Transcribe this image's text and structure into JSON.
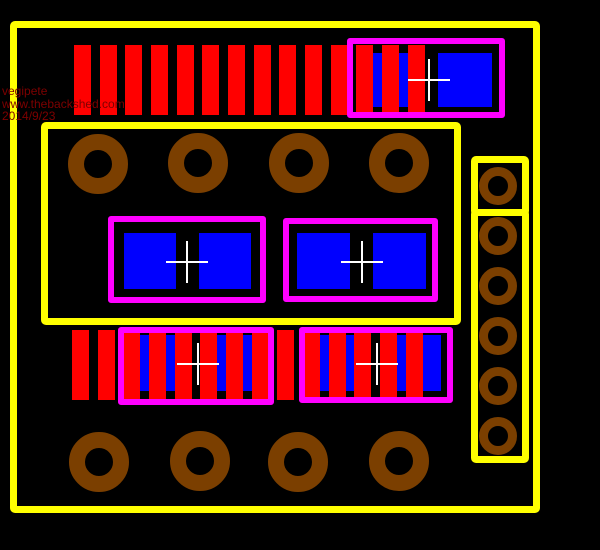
{
  "scene": {
    "kind": "pcb-layout-render",
    "canvas_w": 600,
    "canvas_h": 550
  },
  "watermark": {
    "lines": [
      "vegipete",
      "www.thebackshed.com",
      "2014/9/23"
    ],
    "color": "#7E0000"
  },
  "palette": {
    "background": "#000000",
    "outline_yellow": "#FFFF00",
    "silkscreen_magenta": "#FF00FF",
    "pad_blue": "#0000FF",
    "copper_red": "#FF0000",
    "hole_brown": "#7B3F00",
    "crosshair_white": "#FFFFFF"
  },
  "board": {
    "yellow_outlines": [
      {
        "name": "board-outline",
        "x": 10,
        "y": 21,
        "w": 530,
        "h": 492,
        "stroke": 7
      },
      {
        "name": "inner-block-outline",
        "x": 41,
        "y": 122,
        "w": 420,
        "h": 203,
        "stroke": 7
      },
      {
        "name": "right-header-outline-top",
        "x": 471,
        "y": 156,
        "w": 58,
        "h": 60,
        "stroke": 7
      },
      {
        "name": "right-header-outline-bottom",
        "x": 471,
        "y": 209,
        "w": 58,
        "h": 254,
        "stroke": 7
      }
    ],
    "component_outlines": [
      {
        "name": "component-outline-top-right",
        "x": 347,
        "y": 38,
        "w": 158,
        "h": 80,
        "stroke": 6
      },
      {
        "name": "component-outline-mid-left",
        "x": 108,
        "y": 216,
        "w": 158,
        "h": 87,
        "stroke": 6
      },
      {
        "name": "component-outline-mid-right",
        "x": 283,
        "y": 218,
        "w": 155,
        "h": 84,
        "stroke": 6
      },
      {
        "name": "component-outline-bottom-left",
        "x": 118,
        "y": 327,
        "w": 156,
        "h": 78,
        "stroke": 6
      },
      {
        "name": "component-outline-bottom-right",
        "x": 299,
        "y": 327,
        "w": 154,
        "h": 76,
        "stroke": 6
      }
    ],
    "pin_bar_rows": [
      {
        "name": "pin-row-top",
        "x": 74,
        "y": 45,
        "count": 14,
        "pitch": 25.66,
        "bar_w": 17,
        "bar_h": 70
      },
      {
        "name": "pin-row-bottom",
        "x": 72,
        "y": 330,
        "count": 14,
        "pitch": 25.66,
        "bar_w": 17,
        "bar_h": 70
      }
    ],
    "smd_pads": [
      {
        "name": "smd-pad",
        "x": 370,
        "y": 53,
        "w": 54,
        "h": 54
      },
      {
        "name": "smd-pad",
        "x": 438,
        "y": 53,
        "w": 54,
        "h": 54
      },
      {
        "name": "smd-pad",
        "x": 124,
        "y": 233,
        "w": 52,
        "h": 56
      },
      {
        "name": "smd-pad",
        "x": 199,
        "y": 233,
        "w": 52,
        "h": 56
      },
      {
        "name": "smd-pad",
        "x": 297,
        "y": 233,
        "w": 53,
        "h": 56
      },
      {
        "name": "smd-pad",
        "x": 373,
        "y": 233,
        "w": 53,
        "h": 56
      },
      {
        "name": "smd-pad",
        "x": 135,
        "y": 335,
        "w": 52,
        "h": 56
      },
      {
        "name": "smd-pad",
        "x": 210,
        "y": 335,
        "w": 52,
        "h": 56
      },
      {
        "name": "smd-pad",
        "x": 314,
        "y": 335,
        "w": 52,
        "h": 56
      },
      {
        "name": "smd-pad",
        "x": 389,
        "y": 335,
        "w": 52,
        "h": 56
      }
    ],
    "drill_holes": [
      {
        "name": "drill-hole",
        "cx": 98,
        "cy": 164,
        "ro": 30,
        "ri": 14
      },
      {
        "name": "drill-hole",
        "cx": 198,
        "cy": 163,
        "ro": 30,
        "ri": 14
      },
      {
        "name": "drill-hole",
        "cx": 299,
        "cy": 163,
        "ro": 30,
        "ri": 14
      },
      {
        "name": "drill-hole",
        "cx": 399,
        "cy": 163,
        "ro": 30,
        "ri": 14
      },
      {
        "name": "drill-hole",
        "cx": 99,
        "cy": 462,
        "ro": 30,
        "ri": 14
      },
      {
        "name": "drill-hole",
        "cx": 200,
        "cy": 461,
        "ro": 30,
        "ri": 14
      },
      {
        "name": "drill-hole",
        "cx": 298,
        "cy": 462,
        "ro": 30,
        "ri": 14
      },
      {
        "name": "drill-hole",
        "cx": 399,
        "cy": 461,
        "ro": 30,
        "ri": 14
      },
      {
        "name": "drill-hole-small",
        "cx": 498,
        "cy": 186,
        "ro": 19,
        "ri": 10
      },
      {
        "name": "drill-hole-small",
        "cx": 498,
        "cy": 236,
        "ro": 19,
        "ri": 10
      },
      {
        "name": "drill-hole-small",
        "cx": 498,
        "cy": 286,
        "ro": 19,
        "ri": 10
      },
      {
        "name": "drill-hole-small",
        "cx": 498,
        "cy": 336,
        "ro": 19,
        "ri": 10
      },
      {
        "name": "drill-hole-small",
        "cx": 498,
        "cy": 386,
        "ro": 19,
        "ri": 10
      },
      {
        "name": "drill-hole-small",
        "cx": 498,
        "cy": 436,
        "ro": 19,
        "ri": 10
      }
    ],
    "origin_crosshairs": [
      {
        "name": "origin-crosshair",
        "cx": 429,
        "cy": 80,
        "arm": 21,
        "thickness": 2
      },
      {
        "name": "origin-crosshair",
        "cx": 187,
        "cy": 262,
        "arm": 21,
        "thickness": 2
      },
      {
        "name": "origin-crosshair",
        "cx": 362,
        "cy": 262,
        "arm": 21,
        "thickness": 2
      },
      {
        "name": "origin-crosshair",
        "cx": 198,
        "cy": 364,
        "arm": 21,
        "thickness": 2
      },
      {
        "name": "origin-crosshair",
        "cx": 377,
        "cy": 364,
        "arm": 21,
        "thickness": 2
      }
    ]
  }
}
